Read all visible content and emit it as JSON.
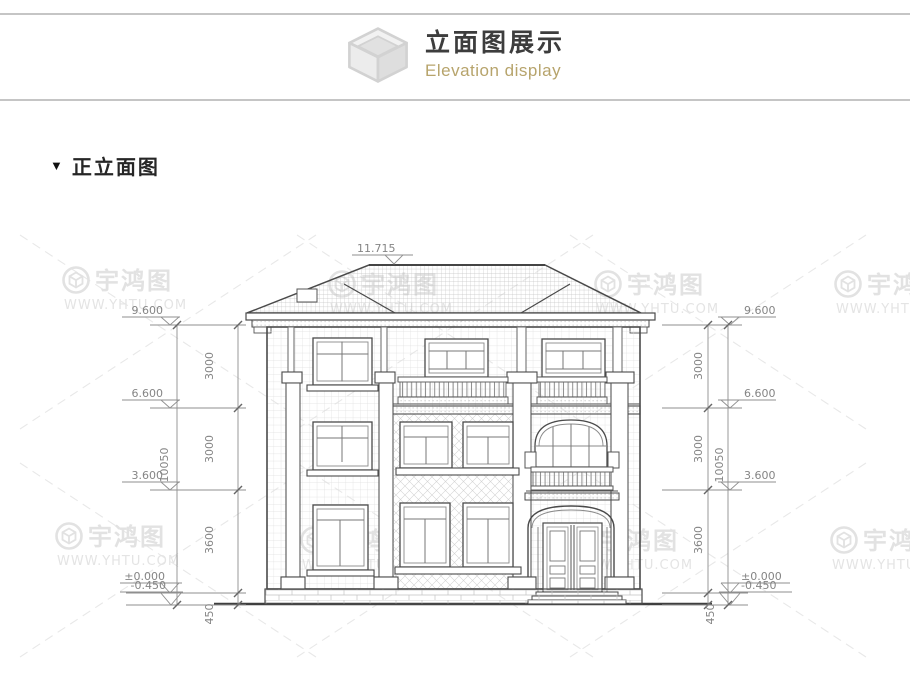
{
  "header": {
    "title": "立面图展示",
    "subtitle": "Elevation display"
  },
  "section": {
    "marker": "▼",
    "title": "正立面图"
  },
  "watermark": {
    "brand": "宇鸿图",
    "url": "WWW.YHTU.COM"
  },
  "dims": {
    "ridge": "11.715",
    "levels": [
      "9.600",
      "6.600",
      "3.600",
      "±0.000",
      "-0.450"
    ],
    "segments": [
      "3000",
      "3000",
      "3600",
      "450"
    ],
    "overall": "10050"
  }
}
